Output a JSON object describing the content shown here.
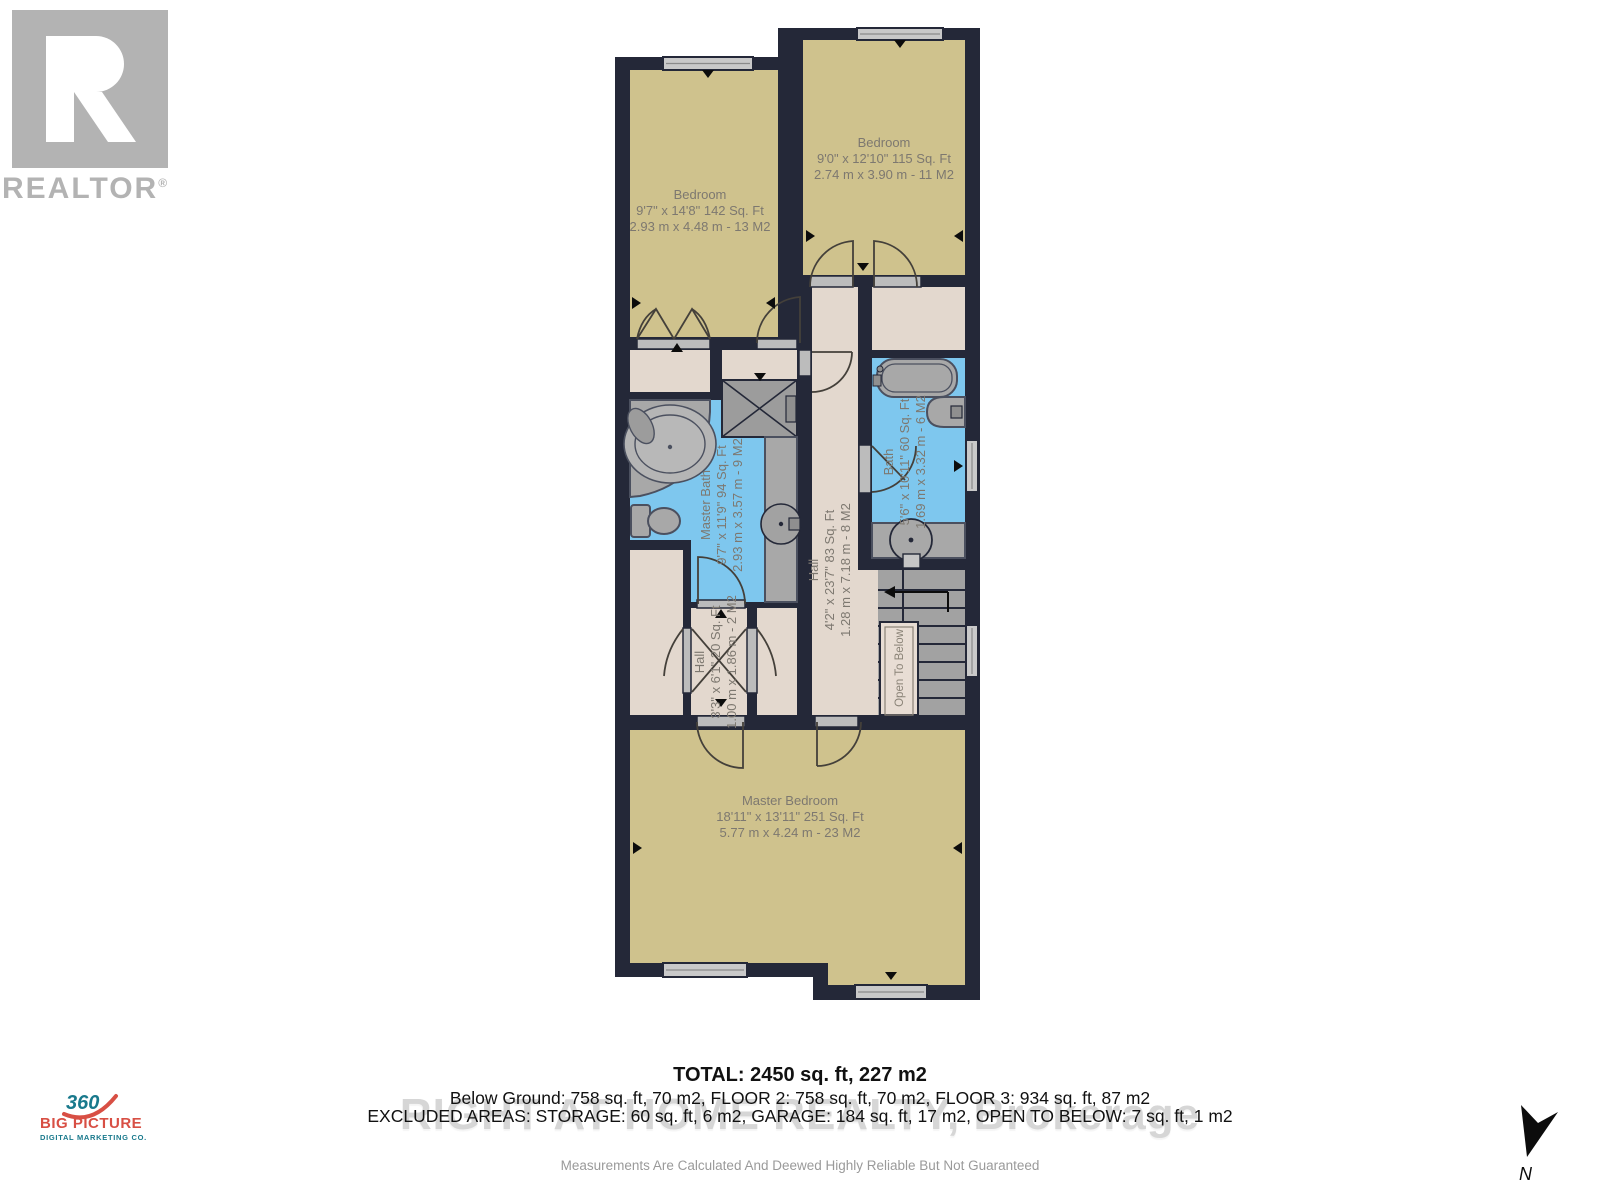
{
  "branding": {
    "realtor": {
      "letter": "R",
      "label": "REALTOR",
      "reg": "®"
    },
    "big_picture": {
      "number": "360",
      "name": "BIG PICTURE",
      "tagline": "DIGITAL MARKETING CO."
    },
    "compass": {
      "label": "N"
    }
  },
  "colors": {
    "wall": "#242838",
    "room_tan": "#cfc28d",
    "room_beige": "#e3d8ce",
    "room_blue": "#7ec7ee",
    "fixture_gray": "#a8a8a8",
    "logo_teal": "#19798c",
    "logo_red": "#d84f44"
  },
  "rooms": {
    "bedroom_top_left": {
      "name": "Bedroom",
      "imperial": "9'7\" x 14'8\" 142 Sq. Ft",
      "metric": "2.93 m x 4.48 m - 13 M2"
    },
    "bedroom_top_right": {
      "name": "Bedroom",
      "imperial": "9'0\" x 12'10\" 115 Sq. Ft",
      "metric": "2.74 m x 3.90 m - 11 M2"
    },
    "master_bath": {
      "name": "Master Bath",
      "imperial": "9'7\" x 11'9\" 94 Sq. Ft",
      "metric": "2.93 m x 3.57 m - 9 M2"
    },
    "hall": {
      "name": "Hall",
      "imperial": "4'2\" x 23'7\" 83 Sq. Ft",
      "metric": "1.28 m x 7.18 m - 8 M2"
    },
    "bath": {
      "name": "Bath",
      "imperial": "5'6\" x 10'11\" 60 Sq. Ft",
      "metric": "1.69 m x 3.32 m - 6 M2"
    },
    "hall_small": {
      "name": "Hall",
      "imperial": "3'3\" x 6'1\" 20 Sq. Ft",
      "metric": "1.00 m x 1.86 m - 2 M2"
    },
    "master_bedroom": {
      "name": "Master Bedroom",
      "imperial": "18'11\" x 13'11\" 251 Sq. Ft",
      "metric": "5.77 m x 4.24 m - 23 M2"
    },
    "open_to_below": {
      "name": "Open To Below"
    }
  },
  "footer": {
    "total": "TOTAL: 2450 sq. ft, 227 m2",
    "floors": "Below Ground: 758 sq. ft, 70 m2, FLOOR 2: 758 sq. ft, 70 m2, FLOOR 3: 934 sq. ft, 87 m2",
    "excluded": "EXCLUDED AREAS: STORAGE: 60 sq. ft, 6 m2, GARAGE: 184 sq. ft, 17 m2, OPEN TO BELOW: 7 sq. ft, 1 m2",
    "watermark": "RIGHT AT HOME REALTY, Brokerage",
    "disclaimer": "Measurements Are Calculated And Deewed Highly Reliable But Not Guaranteed"
  }
}
